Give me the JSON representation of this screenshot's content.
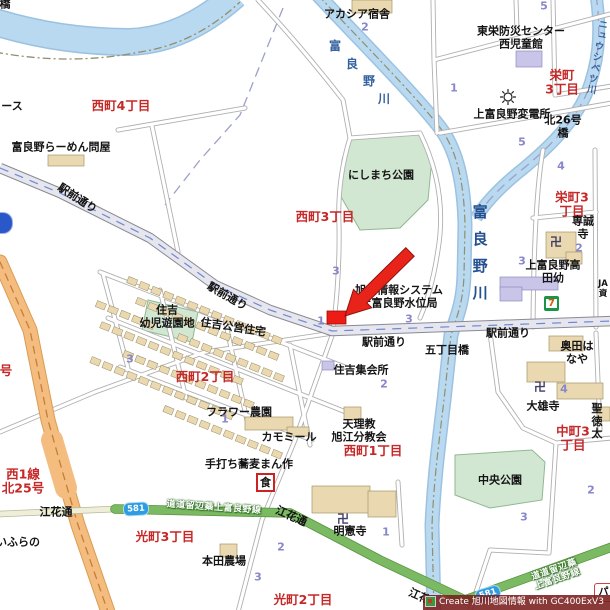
{
  "labels": {
    "d_nishi4": "西町4丁目",
    "d_nishi3": "西町3丁目",
    "d_sakae3_top": "栄町\n3丁目",
    "d_sakae3": "栄町3丁目",
    "d_nishi2": "西町2丁目",
    "d_nishi1": "西町1丁目",
    "d_naka3": "中町3丁目",
    "d_hikari3": "光町3丁目",
    "d_hikari2": "光町2丁目",
    "d_nishi1sen": "西1線\n北25号",
    "d_partial_go": "号",
    "poi_acacia": "アカシア宿舎",
    "poi_bousai": "東栄防災センター\n西児童館",
    "poi_hendensho": "上富良野変電所",
    "poi_kita26": "北26号橋",
    "poi_ramen": "富良野らーめん問屋",
    "poi_partial_su": "ース",
    "poi_partial_hashi": "橋",
    "poi_nishimachi_park": "にしまち公園",
    "poi_senseiji": "専誠寺",
    "poi_takada": "上富良野高田幼",
    "poi_ja": "JA\n資",
    "poi_suii": "旭川情報システム\n上富良野水位局",
    "road_ekimae": "駅前通り",
    "poi_gochome": "五丁目橋",
    "poi_sumiyoshi": "住吉\n幼児遊園地",
    "poi_kouei": "住吉公営住宅",
    "poi_shukaisho": "住吉集会所",
    "poi_flower": "フラワー農園",
    "poi_camomile": "カモミール",
    "poi_tenrikyo": "天理教\n旭江分教会",
    "poi_mansaku": "手打ち蕎麦まん作",
    "poi_okuda": "奥田はなや",
    "poi_daiyuji": "大雄寺",
    "poi_shotoku": "聖徳太",
    "poi_chuo_park": "中央公園",
    "poi_meikenji": "明憲寺",
    "poi_honda": "本田農場",
    "poi_partial_furano": "いふらの",
    "road_ebana": "江花通",
    "road_ebana_partial": "江花",
    "road_dodo": "道道留辺蘂上富良野線",
    "river_furano": "富良野川",
    "river_nyushibetsu": "ニュウシベツ川",
    "route_581": "581",
    "icon_manji": "卍",
    "icon_restaurant": "食",
    "icon_seven": "7",
    "icon_pa": "パ"
  },
  "numbers": [
    "2",
    "5",
    "1",
    "5",
    "4",
    "2",
    "3",
    "3",
    "1",
    "3",
    "3",
    "2",
    "1",
    "4",
    "2",
    "3",
    "1",
    "2",
    "3"
  ],
  "watermark": "Create 旭川地図情報 with GC400ExV3",
  "colors": {
    "district_red": "#c62828",
    "block_number_blue": "#8787c9",
    "river_fill": "#b9d9f0",
    "river_text": "#34619f",
    "park_fill": "#d2e7d2",
    "house_fill": "#ead9b0",
    "public_building_fill": "#c9c5e8",
    "main_road_fill": "#e6e6ee",
    "orange_road_fill": "#f5bc80",
    "green_road_fill": "#7cb963",
    "route_shield_blue": "#2f9be0",
    "marker_red": "#ed1c16",
    "arrow_red": "#e8231a",
    "watermark_bg": "#7a1e1e"
  }
}
